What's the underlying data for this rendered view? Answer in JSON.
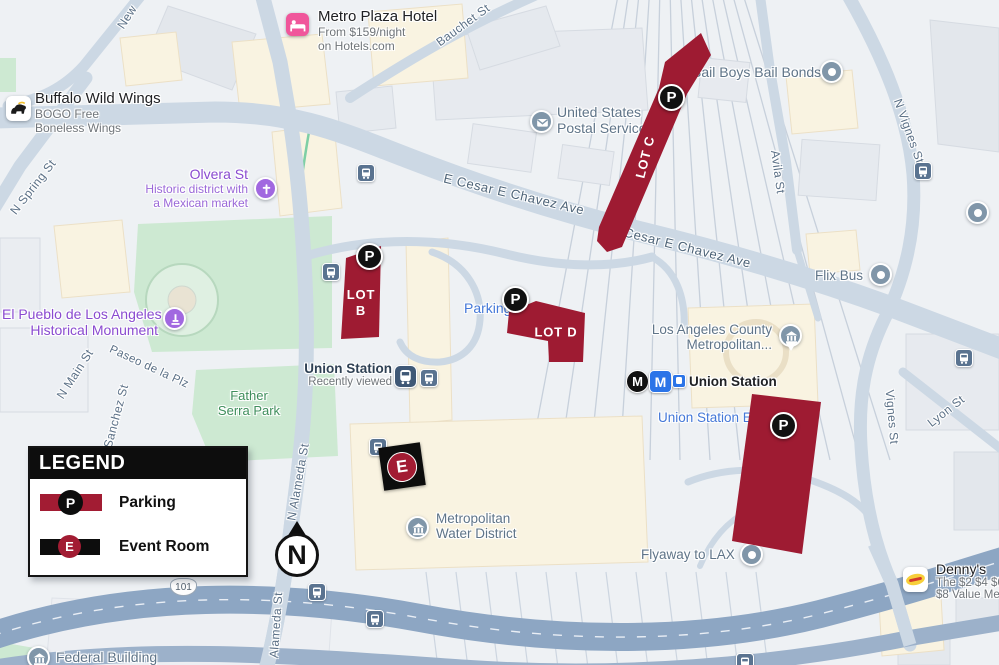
{
  "colors": {
    "lot_red": "#9e1b32",
    "legend_red": "#a21c33",
    "marker_black": "#111111",
    "metro_blue": "#2b74e8",
    "poi_purple": "#8a4bd0"
  },
  "legend": {
    "title": "LEGEND",
    "items": [
      {
        "symbol": "P",
        "label": "Parking"
      },
      {
        "symbol": "E",
        "label": "Event Room"
      }
    ]
  },
  "compass": {
    "label": "N"
  },
  "highway": {
    "route": "101"
  },
  "markers": {
    "parking": "P",
    "event": "E"
  },
  "lots": {
    "lot_b_line1": "LOT",
    "lot_b_line2": "B",
    "lot_c": "LOT C",
    "lot_d": "LOT D"
  },
  "pois": {
    "metro_plaza_hotel": {
      "name": "Metro Plaza Hotel",
      "detail1": "From $159/night",
      "detail2": "on Hotels.com"
    },
    "buffalo_wild_wings": {
      "name": "Buffalo Wild Wings",
      "detail1": "BOGO Free",
      "detail2": "Boneless Wings"
    },
    "olvera_st": {
      "name": "Olvera St",
      "detail1": "Historic district with",
      "detail2": "a Mexican market"
    },
    "el_pueblo": {
      "name1": "El Pueblo de Los Angeles",
      "name2": "Historical Monument"
    },
    "usps": {
      "name1": "United States",
      "name2": "Postal Service"
    },
    "bail_bonds": {
      "name": "Bail Boys Bail Bonds"
    },
    "flix_bus": {
      "name": "Flix Bus"
    },
    "la_county_metro": {
      "name1": "Los Angeles County",
      "name2": "Metropolitan..."
    },
    "union_station": {
      "name": "Union Station",
      "detail": "Recently viewed"
    },
    "union_station_stop": {
      "name": "Union Station",
      "metro_letter": "M"
    },
    "union_station_east": {
      "name": "Union Station E"
    },
    "parking_label": {
      "name": "Parking"
    },
    "father_serra_park": {
      "name1": "Father",
      "name2": "Serra Park"
    },
    "metropolitan_water_district": {
      "name1": "Metropolitan",
      "name2": "Water District"
    },
    "flyaway_lax": {
      "name": "Flyaway to LAX"
    },
    "dennys": {
      "name": "Denny's",
      "detail1": "The $2 $4 $6",
      "detail2": "$8 Value Men"
    },
    "federal_building": {
      "name": "Federal Building"
    }
  },
  "streets": {
    "n_spring": "N Spring St",
    "new_high": "New",
    "bauchet": "Bauchet St",
    "cesar_chavez_w": "E Cesar E Chavez Ave",
    "cesar_chavez_e": "E Cesar E Chavez Ave",
    "avila": "Avila St",
    "n_vignes": "N Vignes St",
    "vignes": "Vignes St",
    "lyon": "Lyon St",
    "n_main": "N Main St",
    "paseo": "Paseo de la Plz",
    "sanchez": "Sanchez St",
    "n_alameda": "N Alameda St",
    "alameda": "Alameda St"
  }
}
